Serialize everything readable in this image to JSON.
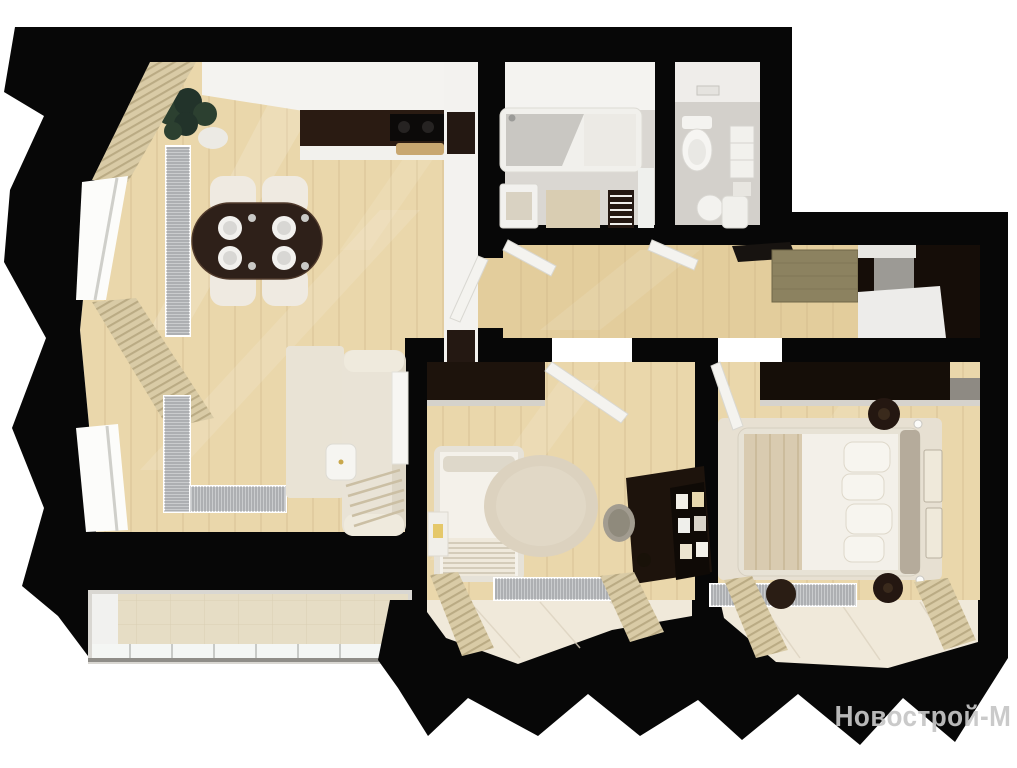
{
  "watermark": {
    "text": "Новострой-М"
  },
  "palette": {
    "wall": "#070707",
    "wood": "#ead7ab",
    "woodLine": "#c9b183",
    "woodHall": "#e3cd9c",
    "ceiling": "#f4f3f0",
    "counterDark": "#2a1b12",
    "darkFurniture": "#1d130c",
    "chairWhite": "#efeae1",
    "sofa": "#e9e3d6",
    "rugCream": "#e9e3d5",
    "rugRound": "#dcd2bf",
    "rugSisal": "#8c8260",
    "rugBedroom": "#e7e0d2",
    "bathTile": "#dad7d2",
    "wcTile": "#d3d0cb",
    "balconyTile": "#e6ddc5",
    "bayFloor": "#f0e9da",
    "curtain": "#d9cba6",
    "curtainStripe": "#b3a37c",
    "radiator": "#caccce",
    "radiatorLine": "#606468",
    "doorWhite": "#f4f3ef",
    "plant": "#2c4030",
    "watermark": "#c6c6c6"
  },
  "rooms": [
    {
      "name": "kitchen-dining-living-room"
    },
    {
      "name": "bathroom"
    },
    {
      "name": "toilet"
    },
    {
      "name": "hallway"
    },
    {
      "name": "kids-room"
    },
    {
      "name": "bedroom"
    },
    {
      "name": "balcony"
    }
  ]
}
